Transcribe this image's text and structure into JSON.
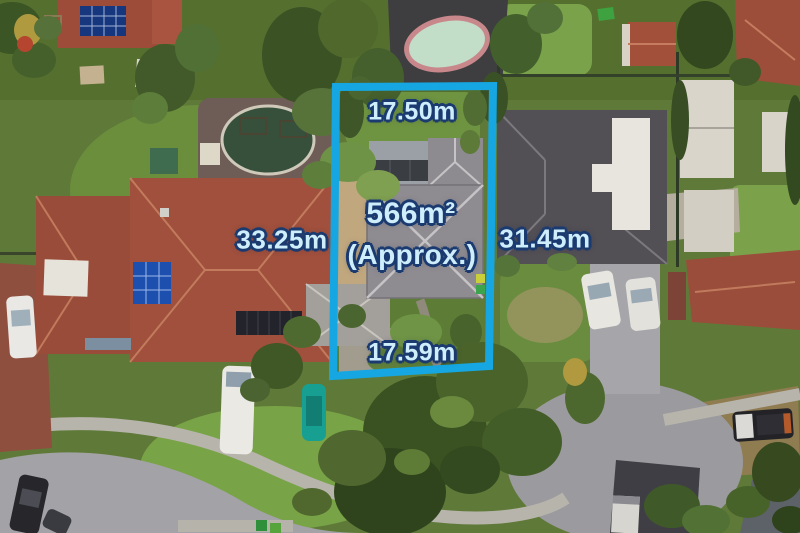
{
  "overlay": {
    "boundary_color": "#16a7e2",
    "label_fill": "#cfeefc",
    "label_outline": "#1a3a70",
    "labels": {
      "top_width": "17.50m",
      "area": "566m²",
      "area_qualifier": "(Approx.)",
      "bottom_width": "17.59m",
      "left_property_width": "33.25m",
      "right_property_width": "31.45m"
    }
  }
}
